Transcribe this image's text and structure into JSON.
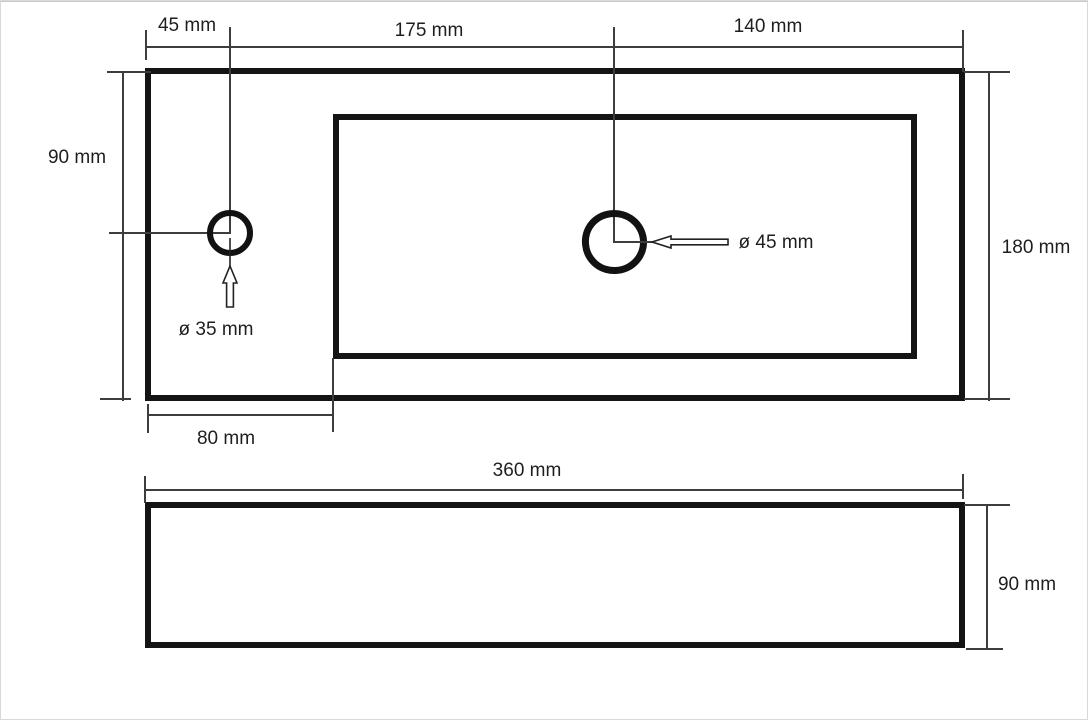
{
  "colors": {
    "background": "#ffffff",
    "outline": "#141414",
    "dimension_line": "#3d3d3d",
    "text": "#1e1e1e"
  },
  "top_view": {
    "dim_45": "45 mm",
    "dim_175": "175 mm",
    "dim_140": "140 mm",
    "dim_90": "90 mm",
    "dim_180": "180 mm",
    "dim_80": "80 mm",
    "faucet_hole_diameter": "ø 35 mm",
    "drain_hole_diameter": "ø 45 mm"
  },
  "front_view": {
    "dim_360": "360 mm",
    "dim_90": "90 mm"
  },
  "icons": {
    "up_arrow": "up-arrow-leader",
    "left_arrow": "left-arrow-leader"
  }
}
